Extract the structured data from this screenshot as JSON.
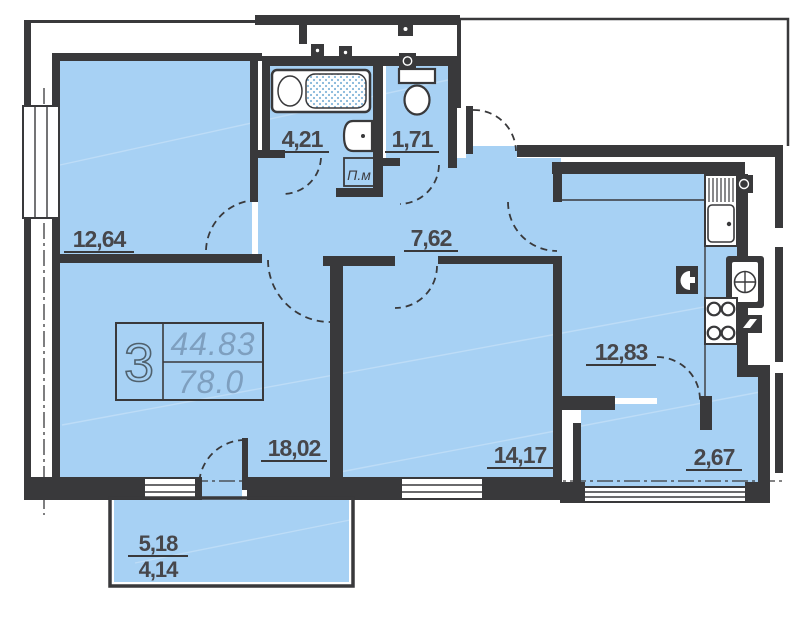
{
  "plan": {
    "stamp": {
      "rooms": "3",
      "area_living": "44.83",
      "area_total": "78.0"
    },
    "rooms": [
      {
        "id": "bedroom-1",
        "area": "12,64"
      },
      {
        "id": "bathroom",
        "area": "4,21"
      },
      {
        "id": "wc",
        "area": "1,71"
      },
      {
        "id": "hall",
        "area": "7,62"
      },
      {
        "id": "kitchen",
        "area": "12,83"
      },
      {
        "id": "living-room",
        "area": "18,02"
      },
      {
        "id": "bedroom-2",
        "area": "14,17"
      },
      {
        "id": "loggia",
        "area": "2,67"
      }
    ],
    "balcony": {
      "area_full": "5,18",
      "area_reduced": "4,14"
    },
    "shaft_label": "П.м",
    "colors": {
      "floor_fill": "#a7d1f4",
      "wall": "#39393b",
      "label_text": "#47474b",
      "stamp_value": "#7e9fbf",
      "stamp_rooms": "#50616d"
    }
  }
}
